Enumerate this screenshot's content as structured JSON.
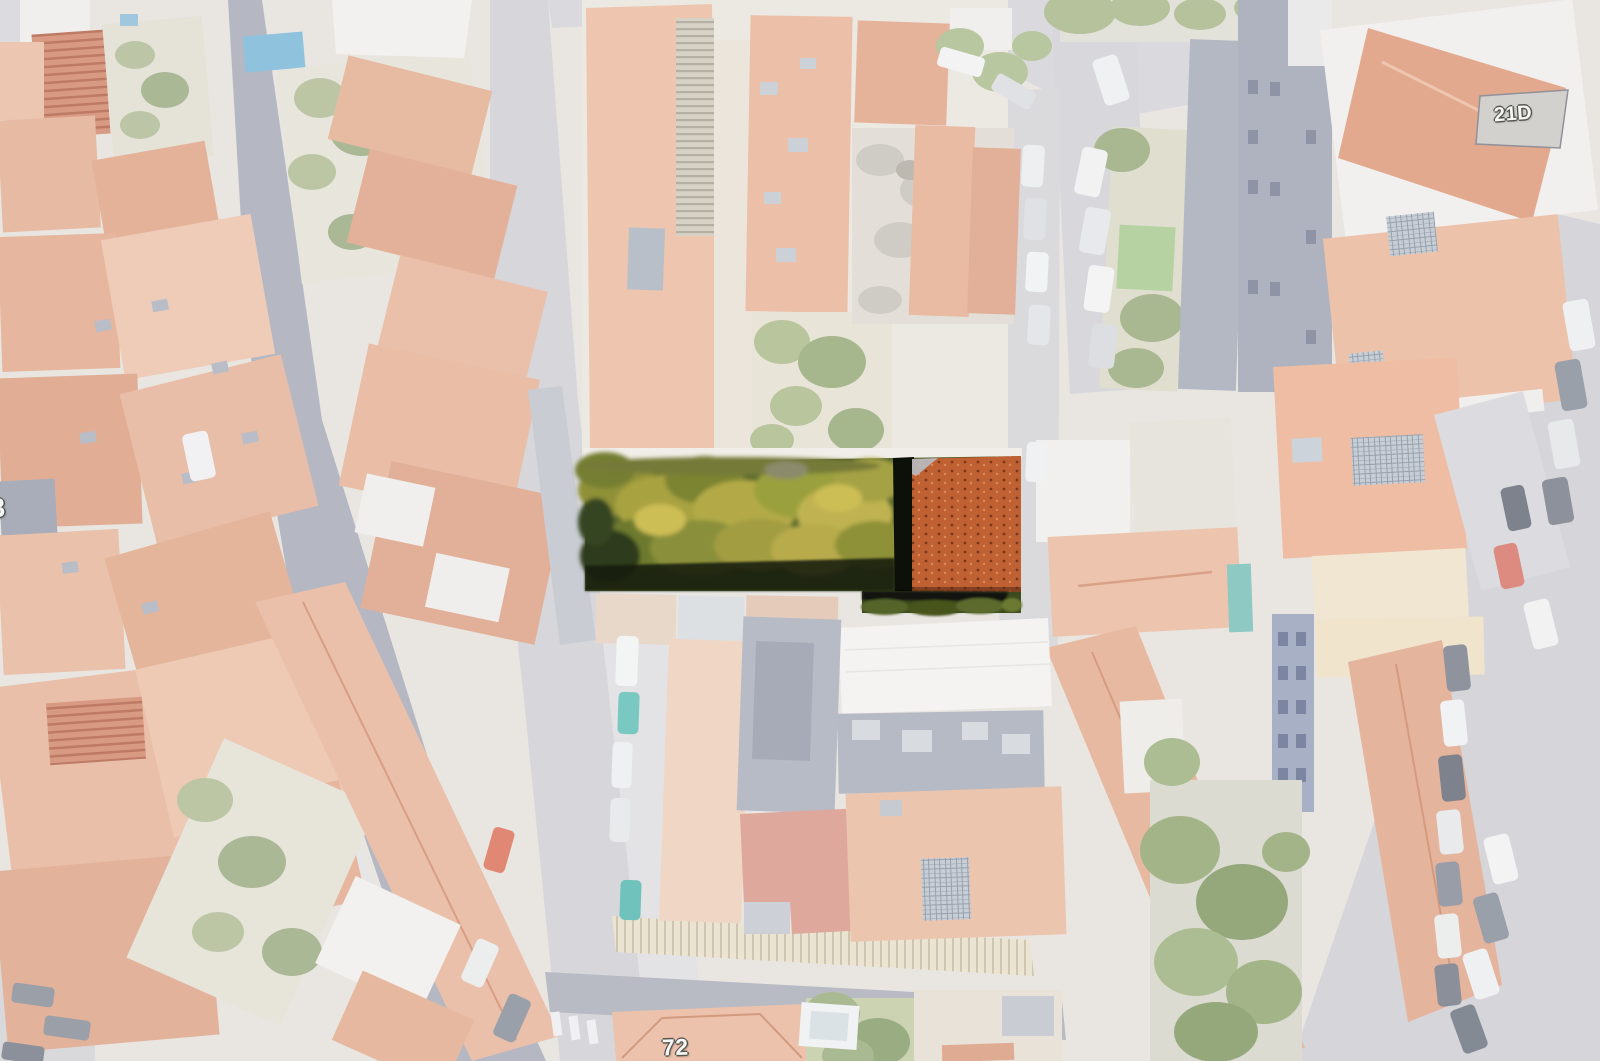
{
  "map": {
    "kind": "aerial satellite view with highlighted parcel",
    "roof_labels": [
      {
        "id": "21d",
        "text": "21D"
      },
      {
        "id": "72",
        "text": "72"
      },
      {
        "id": "8",
        "text": "8"
      }
    ],
    "highlight": {
      "label": "selected-parcel",
      "garden_color": "#5c6a2d",
      "roof_color": "#c06134",
      "shadow_color": "#14180e"
    },
    "palette": {
      "washed_roof_salmon": "#eac2ac",
      "washed_street": "#d8d8dc",
      "washed_dark_lane": "#b6b9c4",
      "washed_white_building": "#f3f1ef",
      "washed_vegetation": "#b7c39d",
      "blue_tarp": "#8fc2dd",
      "teal_car": "#79c8c1",
      "red_car": "#dd8b80",
      "overlay_veil": "rgba(255,255,255,0.58)"
    }
  }
}
